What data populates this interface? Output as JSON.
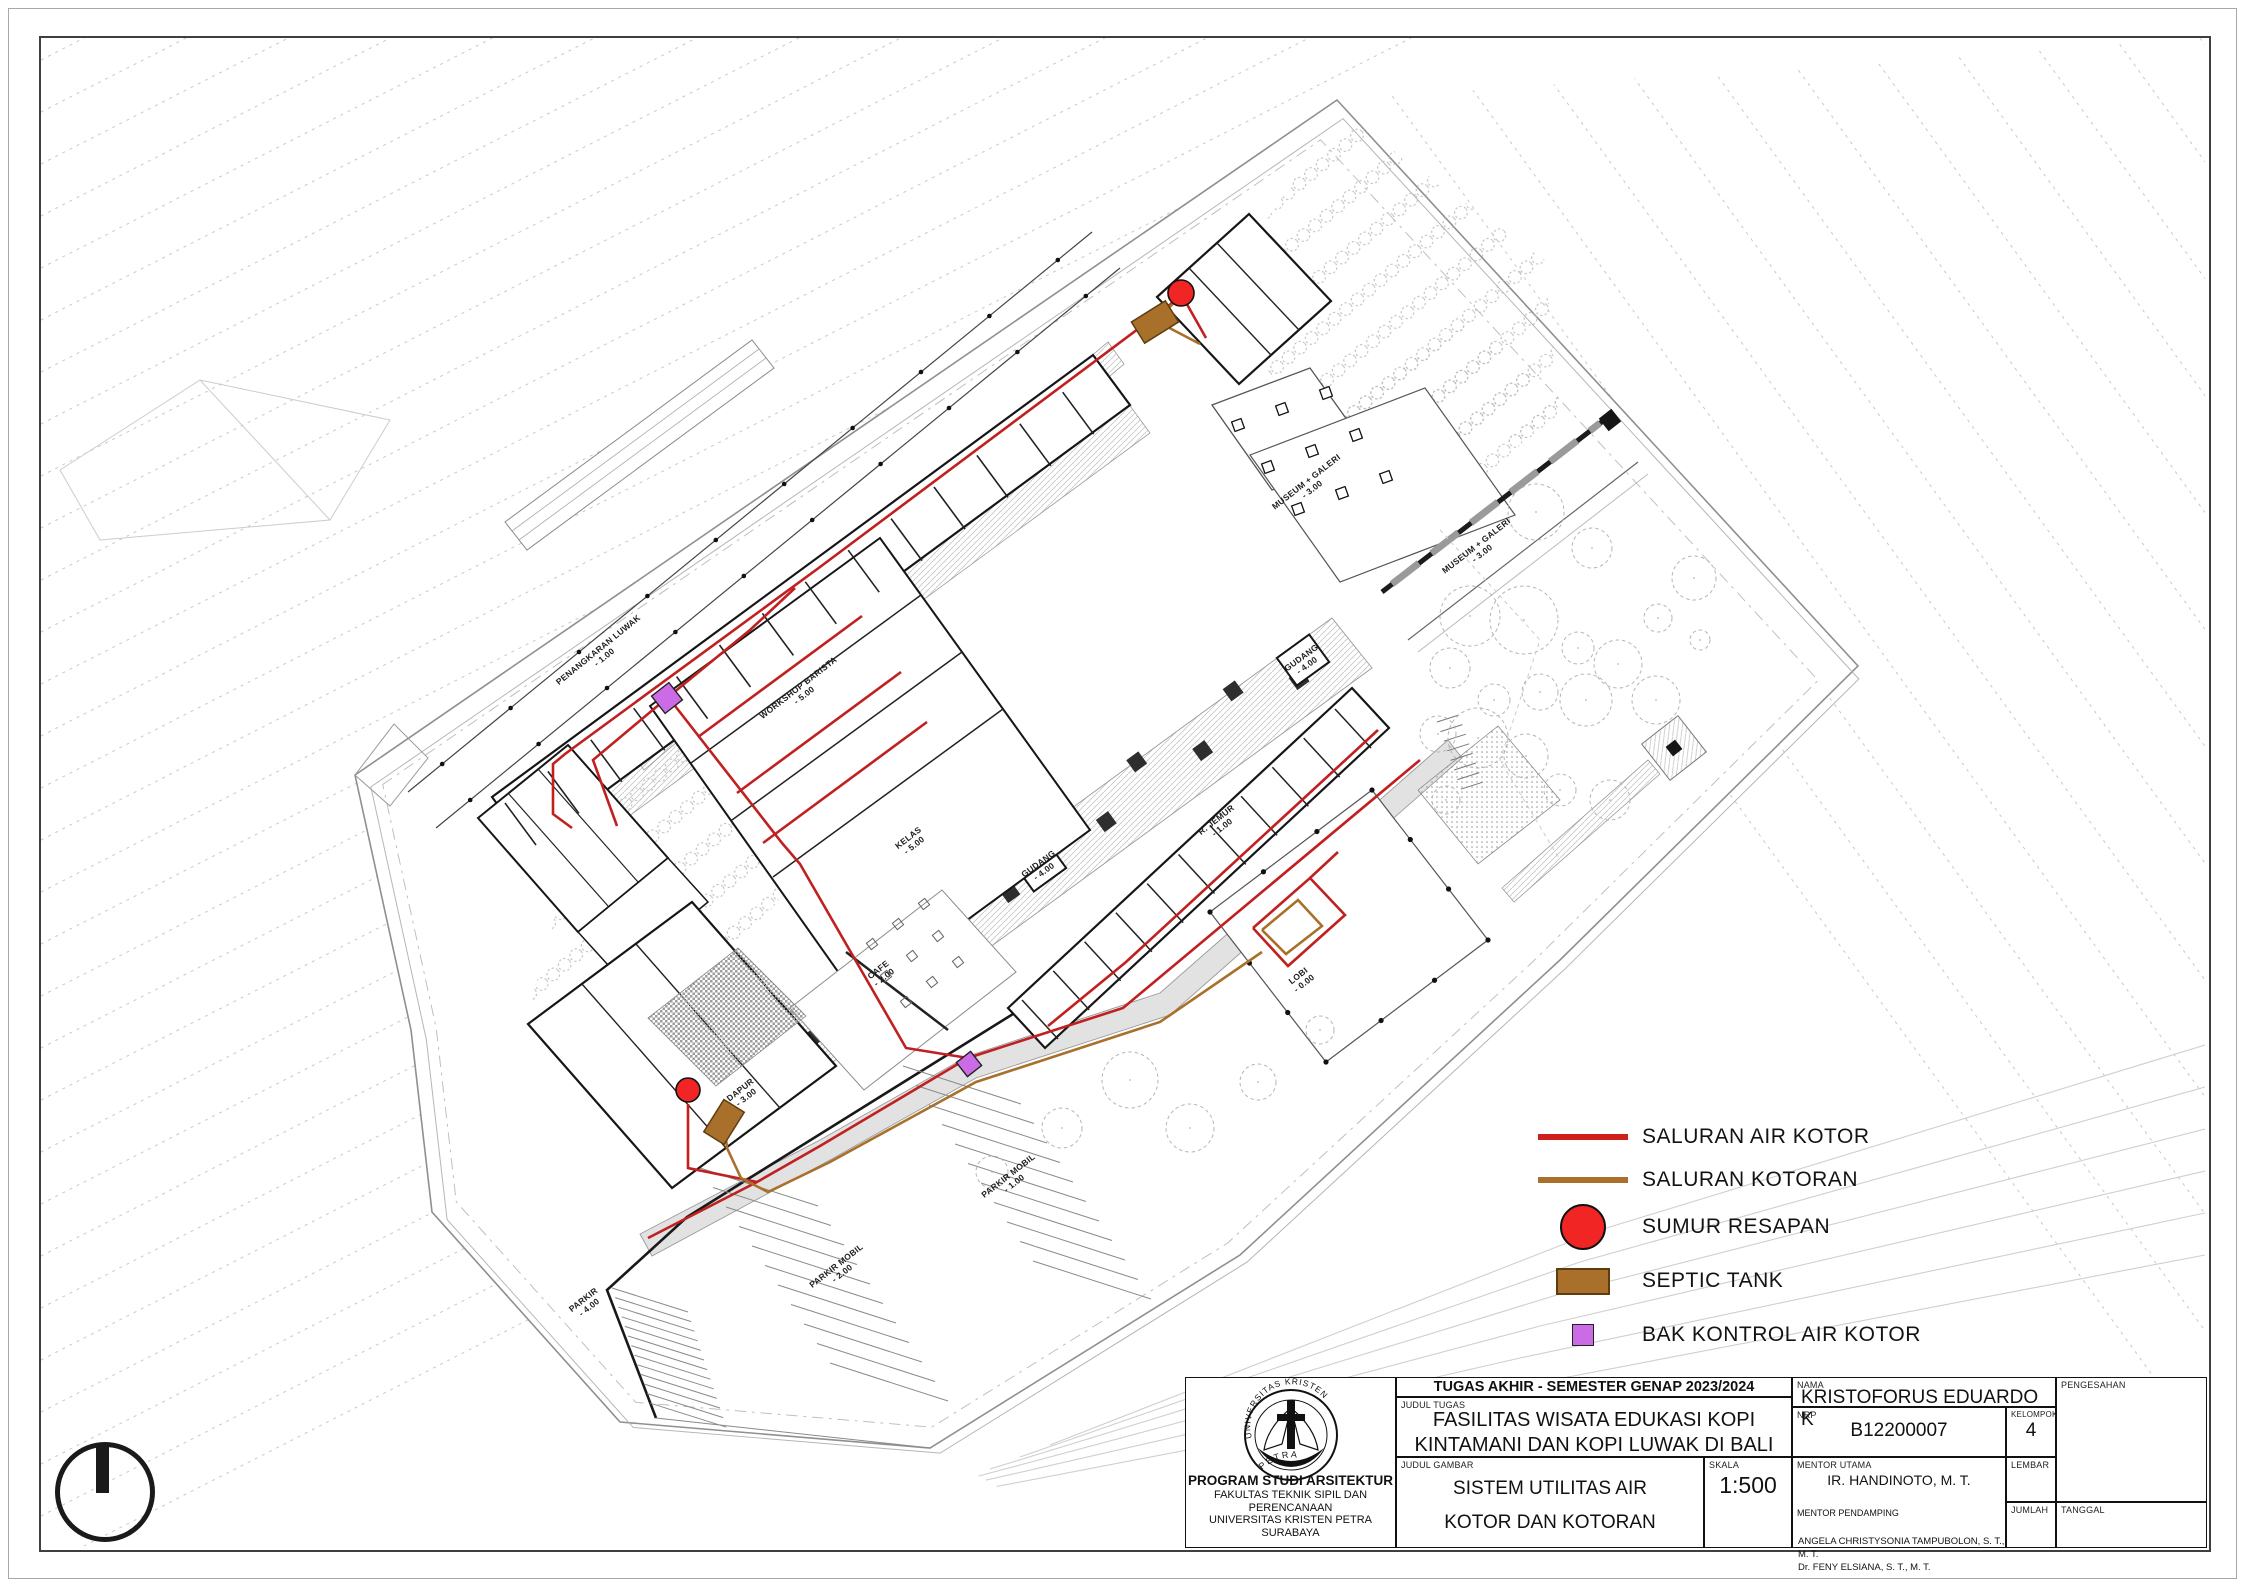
{
  "legend": {
    "items": [
      {
        "label": "SALURAN AIR KOTOR",
        "swatch": "line-red"
      },
      {
        "label": "SALURAN KOTORAN",
        "swatch": "line-brown"
      },
      {
        "label": "SUMUR RESAPAN",
        "swatch": "circle-red"
      },
      {
        "label": "SEPTIC TANK",
        "swatch": "rect-brown"
      },
      {
        "label": "BAK KONTROL AIR KOTOR",
        "swatch": "square-purple"
      }
    ]
  },
  "title_block": {
    "header": "TUGAS AKHIR - SEMESTER GENAP 2023/2024",
    "judul_tugas_label": "JUDUL TUGAS",
    "judul_tugas_line1": "FASILITAS WISATA EDUKASI KOPI",
    "judul_tugas_line2": "KINTAMANI DAN KOPI LUWAK DI BALI",
    "judul_gambar_label": "JUDUL GAMBAR",
    "judul_gambar_line1": "SISTEM UTILITAS AIR",
    "judul_gambar_line2": "KOTOR DAN KOTORAN",
    "skala_label": "SKALA",
    "skala": "1:500",
    "nama_label": "NAMA",
    "nama": "KRISTOFORUS EDUARDO K",
    "nrp_label": "NRP",
    "nrp": "B12200007",
    "kelompok_label": "KELOMPOK",
    "kelompok": "4",
    "mentor_utama_label": "MENTOR UTAMA",
    "mentor_utama": "IR. HANDINOTO,  M. T.",
    "mentor_pendamping_label": "MENTOR PENDAMPING",
    "mentor_pendamping_1": "ANGELA CHRISTYSONIA TAMPUBOLON, S. T., M. T.",
    "mentor_pendamping_2": "Dr. FENY ELSIANA, S. T., M. T.",
    "lembar_label": "LEMBAR",
    "jumlah_label": "JUMLAH",
    "pengesahan_label": "PENGESAHAN",
    "tanggal_label": "TANGGAL",
    "logo": {
      "top_text": "UNIVERSITAS KRISTEN",
      "bottom_text": "PETRA",
      "program": "PROGRAM STUDI ARSITEKTUR",
      "faculty": "FAKULTAS TEKNIK SIPIL DAN PERENCANAAN",
      "university": "UNIVERSITAS KRISTEN PETRA",
      "city": "SURABAYA"
    }
  },
  "colors": {
    "saluran_air_kotor": "#c02020",
    "saluran_kotoran": "#a8702a",
    "sumur_resapan": "#f22525",
    "septic_tank": "#a8702a",
    "bak_kontrol": "#cb6ce6"
  },
  "plan": {
    "labels": [
      {
        "name": "PENANGKARAN LUWAK",
        "level": "- 1.00",
        "x": 600,
        "y": 652,
        "r": -39
      },
      {
        "name": "MUSEUM + GALERI",
        "level": "- 3.00",
        "x": 1308,
        "y": 484,
        "r": -38
      },
      {
        "name": "MUSEUM + GALERI",
        "level": "- 3.00",
        "x": 1478,
        "y": 548,
        "r": -38
      },
      {
        "name": "LOBI",
        "level": "- 0.00",
        "x": 1300,
        "y": 978,
        "r": -38
      },
      {
        "name": "DAPUR",
        "level": "- 3.00",
        "x": 742,
        "y": 1092,
        "r": -38
      },
      {
        "name": "CAFE",
        "level": "- 2.00",
        "x": 880,
        "y": 972,
        "r": -38
      },
      {
        "name": "GUDANG",
        "level": "- 4.00",
        "x": 1040,
        "y": 866,
        "r": -36
      },
      {
        "name": "GUDANG",
        "level": "- 4.00",
        "x": 1303,
        "y": 660,
        "r": -36
      },
      {
        "name": "PARKIR",
        "level": "- 4.00",
        "x": 585,
        "y": 1302,
        "r": -38
      },
      {
        "name": "PARKIR MOBIL",
        "level": "- 2.00",
        "x": 838,
        "y": 1268,
        "r": -38
      },
      {
        "name": "PARKIR MOBIL",
        "level": "- 1.00",
        "x": 1010,
        "y": 1178,
        "r": -38
      },
      {
        "name": "KELAS",
        "level": "- 5.00",
        "x": 910,
        "y": 840,
        "r": -38
      },
      {
        "name": "R. JEMUR",
        "level": "- 1.00",
        "x": 1218,
        "y": 822,
        "r": -38
      },
      {
        "name": "WORKSHOP BARISTA",
        "level": "- 5.00",
        "x": 800,
        "y": 690,
        "r": -38
      }
    ],
    "utilities": {
      "air_kotor": [
        [
          [
            1181,
            296
          ],
          [
            1150,
            320
          ],
          [
            820,
            567
          ],
          [
            565,
            754
          ],
          [
            553,
            764
          ],
          [
            553,
            814
          ],
          [
            572,
            828
          ]
        ],
        [
          [
            1184,
            299
          ],
          [
            1206,
            338
          ]
        ],
        [
          [
            795,
            588
          ],
          [
            750,
            630
          ],
          [
            667,
            698
          ],
          [
            593,
            760
          ],
          [
            617,
            826
          ]
        ],
        [
          [
            672,
            702
          ],
          [
            782,
            843
          ],
          [
            800,
            864
          ],
          [
            906,
            1048
          ],
          [
            968,
            1058
          ]
        ],
        [
          [
            698,
            737
          ],
          [
            862,
            616
          ]
        ],
        [
          [
            737,
            793
          ],
          [
            901,
            672
          ]
        ],
        [
          [
            763,
            843
          ],
          [
            927,
            722
          ]
        ],
        [
          [
            1420,
            760
          ],
          [
            1123,
            1008
          ],
          [
            968,
            1058
          ],
          [
            820,
            1146
          ],
          [
            757,
            1182
          ],
          [
            648,
            1238
          ]
        ],
        [
          [
            1378,
            730
          ],
          [
            1126,
            962
          ],
          [
            1048,
            1026
          ]
        ],
        [
          [
            1253,
            928
          ],
          [
            1310,
            878
          ],
          [
            1345,
            915
          ],
          [
            1288,
            966
          ],
          [
            1253,
            928
          ]
        ],
        [
          [
            1310,
            878
          ],
          [
            1338,
            852
          ]
        ],
        [
          [
            688,
            1104
          ],
          [
            688,
            1168
          ],
          [
            757,
            1182
          ]
        ]
      ],
      "kotoran": [
        [
          [
            1160,
            316
          ],
          [
            1178,
            299
          ]
        ],
        [
          [
            1158,
            322
          ],
          [
            1200,
            344
          ]
        ],
        [
          [
            1262,
            952
          ],
          [
            1160,
            1022
          ],
          [
            976,
            1082
          ],
          [
            830,
            1162
          ],
          [
            768,
            1192
          ],
          [
            741,
            1178
          ],
          [
            727,
            1148
          ],
          [
            725,
            1128
          ]
        ],
        [
          [
            1262,
            930
          ],
          [
            1298,
            900
          ],
          [
            1322,
            926
          ],
          [
            1286,
            954
          ],
          [
            1262,
            930
          ]
        ]
      ]
    },
    "markers": {
      "sumur_resapan": [
        {
          "x": 1181,
          "y": 293,
          "r": 13
        },
        {
          "x": 688,
          "y": 1090,
          "r": 12
        }
      ],
      "septic_tank": [
        {
          "x": 1155,
          "y": 322,
          "w": 40,
          "h": 25,
          "rot": -32
        },
        {
          "x": 724,
          "y": 1122,
          "w": 38,
          "h": 24,
          "rot": -58
        }
      ],
      "bak_kontrol": [
        {
          "x": 667,
          "y": 698,
          "s": 22,
          "rot": -38
        },
        {
          "x": 969,
          "y": 1064,
          "s": 18,
          "rot": -38
        }
      ]
    }
  }
}
